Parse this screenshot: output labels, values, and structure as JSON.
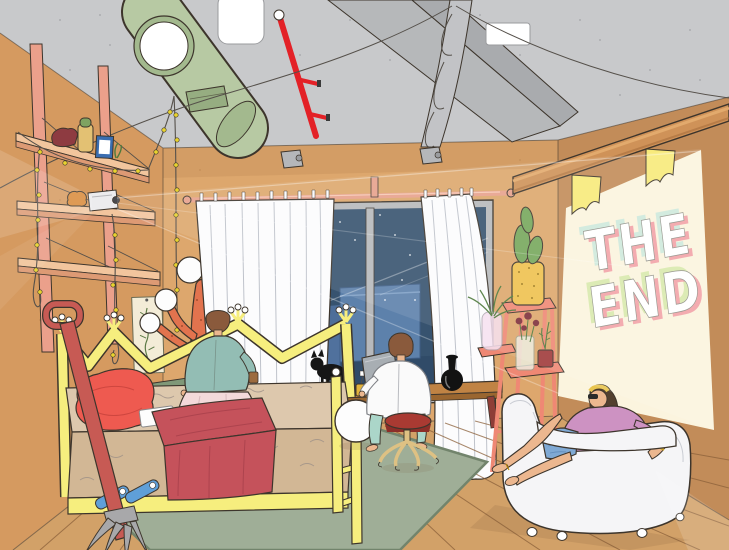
{
  "projection": {
    "line1": "THE",
    "line2": "END"
  },
  "palette": {
    "outline": "#3d352c",
    "ceiling": "#c8c9cb",
    "ceilingBeam": "#b6b8ba",
    "ceilingBeamSide": "#a9abae",
    "speckle": "#a0a1a4",
    "duct": "#b7c9a3",
    "ductDark": "#a3b98e",
    "ductVent": "#96ad81",
    "pipeRed": "#e32127",
    "panel": "#ffffff",
    "drape": "#c2c3c6",
    "wire": "#55504a",
    "wallLeft": "#d59a60",
    "wallBack": "#dda76d",
    "wallRight": "#c28c59",
    "wallShade": "#a97440",
    "rail": "#eba08b",
    "shelfFront": "#f2c59d",
    "shelfUnder": "#dd9a74",
    "floor": "#d2a168",
    "floorLine": "#8b603a",
    "rug": "#9fae97",
    "rugEdge": "#72846c",
    "bedYellow": "#f6ee7e",
    "mattress": "#ddc8ad",
    "mattressFront": "#d2b795",
    "fur": "#9e9188",
    "pillow": "#ee5a50",
    "blanket": "#c5525b",
    "blanketDark": "#a53f4a",
    "curtain": "#fcfcfd",
    "curtainLine": "#b9bdc6",
    "rod": "#e7a18c",
    "windowFrame": "#b7b9bc",
    "night": "#37536f",
    "nightDark": "#2c4663",
    "building": "#5d81ab",
    "building2": "#50719d",
    "star": "#ffffff",
    "skin": "#ecb78f",
    "hair": "#8a5a3c",
    "hairDark": "#53402f",
    "sweater": "#93bdb4",
    "skirt": "#f3d9da",
    "shirt": "#fafafa",
    "pants": "#abd6c9",
    "stoolSeat": "#a93a32",
    "stoolLeg": "#dec183",
    "cat": "#161616",
    "mug": "#e2b33c",
    "vase": "#121212",
    "deskTop": "#c08344",
    "deskFront": "#9a6630",
    "deskLeg": "#8e3d37",
    "stand": "#ef8874",
    "pot": "#efc14e",
    "cactus": "#76a85c",
    "glass": "#eef2e6",
    "jarPink": "#f6dff0",
    "flowerDark": "#7e2f3a",
    "potRed": "#a03a3a",
    "leaf": "#4f7a3c",
    "screen": "#fbf4de",
    "letterMint": "#cfe9dc",
    "letterPink": "#f2a3a8",
    "letterGreen": "#d9e9ad",
    "letterFace": "#ffffff",
    "letterEdge": "#8e8e85",
    "shelfWoodTop": "#e2aa6d",
    "shelfWood": "#cf9258",
    "bracketYellow": "#f8ea7a",
    "sofa": "#f5f5f7",
    "sofaLine": "#c9ccd3",
    "topPink": "#cd92c2",
    "shorts": "#7fa9d4",
    "headband": "#e8c44e",
    "lampCoral": "#e2734e",
    "sphere": "#fdfdfd",
    "poster": "#f3ecd7",
    "plant": "#5c7a46",
    "forkRed": "#c75a54",
    "forkGray": "#a8a8aa",
    "slipper": "#5f9fd8",
    "matGreen": "#7f9878",
    "bulb": "#e8d32f",
    "beamLight": "#ffffff",
    "shadow": "#7a5a38",
    "capRed": "#8e3b41",
    "jarYellow": "#e3c173",
    "frameBlue": "#3a6db0",
    "frogOrange": "#d98a3a",
    "laptopGray": "#a8aeb3",
    "cup": "#9c6b3f"
  }
}
